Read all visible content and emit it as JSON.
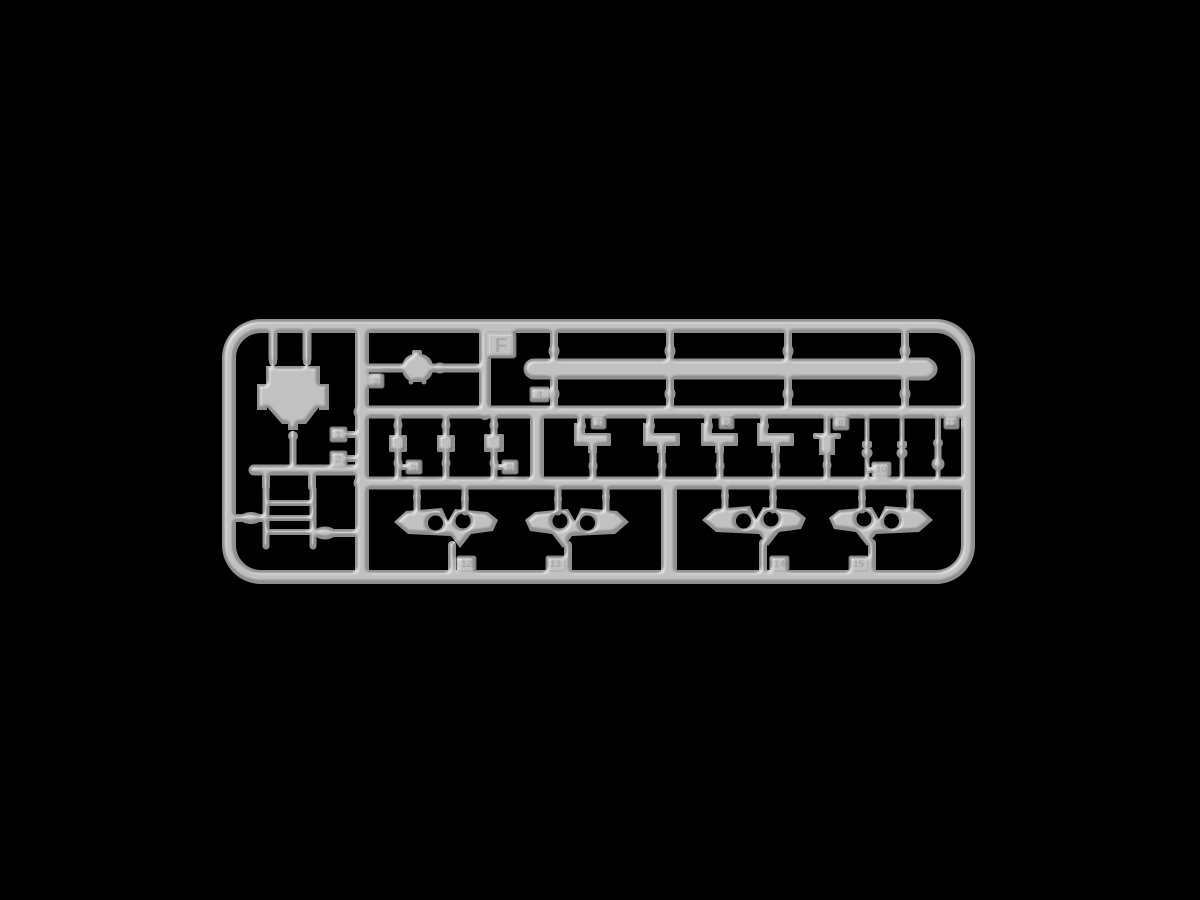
{
  "background_color": "#000000",
  "sprue": {
    "letter": "F",
    "plastic_color": "#8f8f8f",
    "plastic_edge_color": "#6d6d6d",
    "engraving_color": "#6a6a6a",
    "part_tags": [
      "1",
      "2",
      "3",
      "4",
      "5",
      "6",
      "7",
      "8",
      "9",
      "10",
      "11",
      "12",
      "13",
      "14",
      "15"
    ]
  }
}
